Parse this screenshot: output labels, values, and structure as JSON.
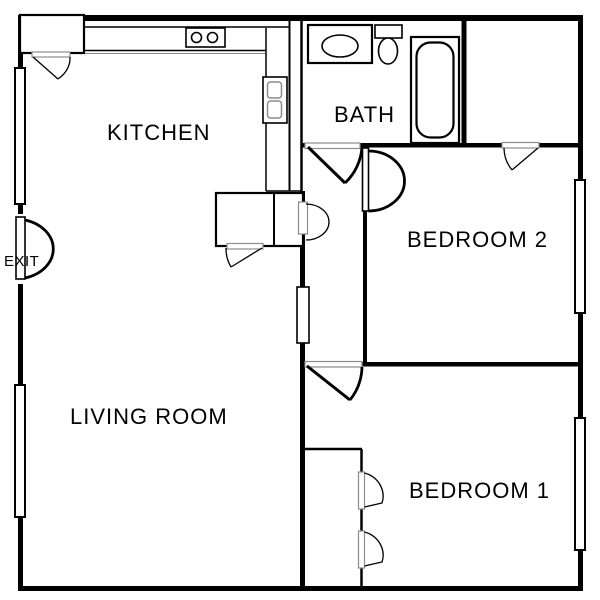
{
  "floor_plan": {
    "canvas": {
      "width": 600,
      "height": 600
    },
    "labels": {
      "kitchen": "KITCHEN",
      "bath": "BATH",
      "bedroom_2": "BEDROOM 2",
      "living_room": "LIVING ROOM",
      "bedroom_1": "BEDROOM 1",
      "exit": "EXIT"
    },
    "fixtures": [
      "refrigerator",
      "kitchen-counter",
      "cooktop",
      "kitchen-sink",
      "pantry-closet",
      "bathroom-vanity-sink",
      "toilet",
      "bathtub",
      "bedroom2-closet",
      "bedroom1-closet",
      "windows",
      "exit-door"
    ],
    "colors": {
      "background": "#ffffff",
      "wall": "#000000",
      "door_frame": "#8c8c8c"
    }
  }
}
